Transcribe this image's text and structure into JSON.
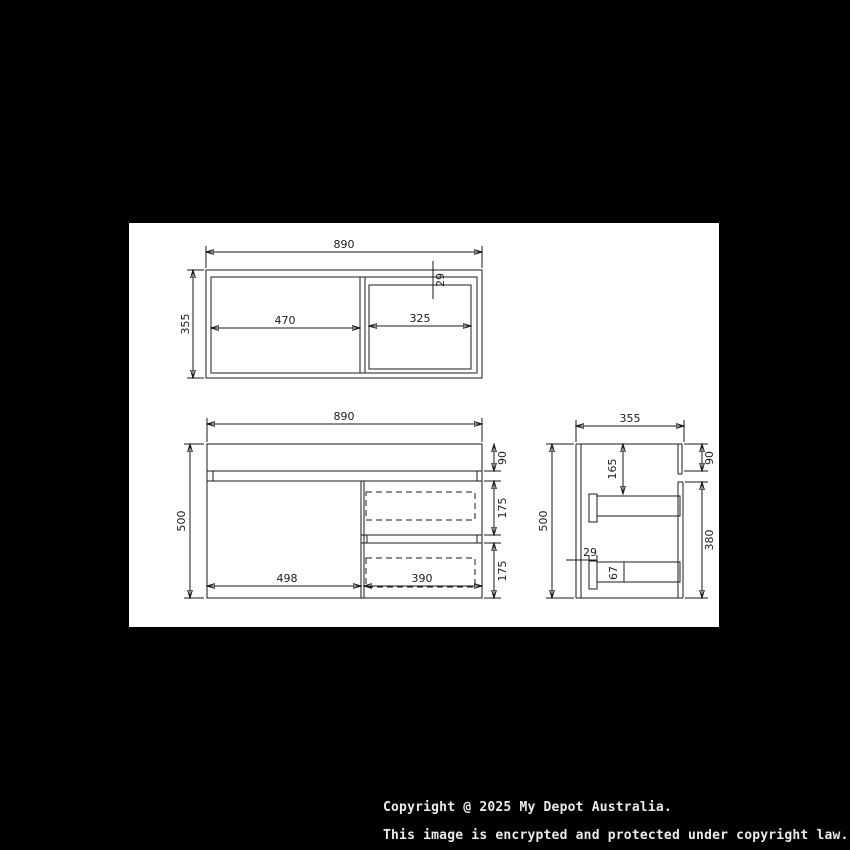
{
  "page": {
    "bg": "#000000",
    "paper_bg": "#ffffff",
    "line_color": "#1a1a1a"
  },
  "plan": {
    "width": "890",
    "depth": "355",
    "left_internal_width": "470",
    "sink_internal_width": "325",
    "back_rail": "29"
  },
  "front": {
    "width": "890",
    "height": "500",
    "counter_height": "90",
    "drawer1_height": "175",
    "drawer2_height": "175",
    "door_width": "498",
    "drawer_width": "390"
  },
  "side": {
    "depth": "355",
    "height": "500",
    "counter_height": "90",
    "runner_offset": "165",
    "body_height": "380",
    "front_lip": "29",
    "runner_height": "67"
  },
  "footer": {
    "line1": "Copyright @ 2025 My Depot Australia.",
    "line2": "This image is encrypted and protected under copyright law."
  }
}
